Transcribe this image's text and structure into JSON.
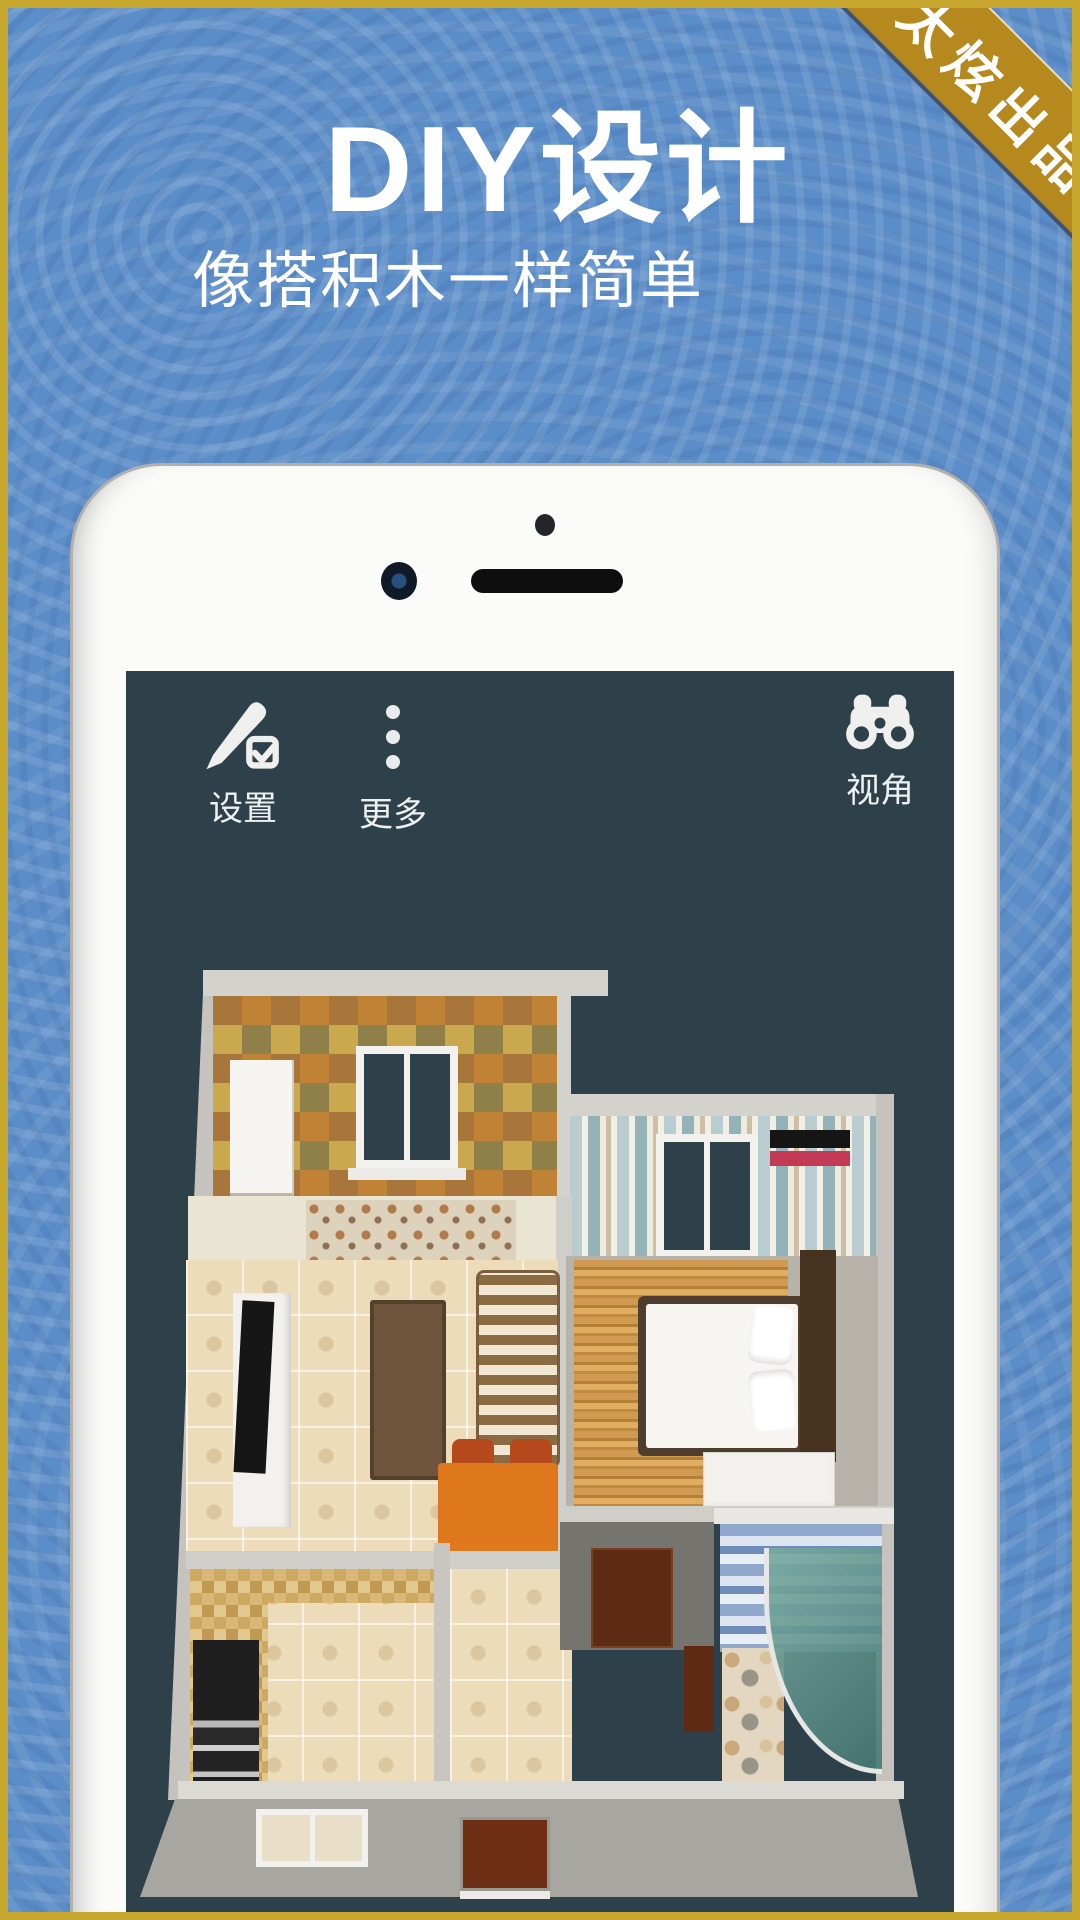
{
  "poster": {
    "ribbon_text": "太炫出品",
    "title": "DIY设计",
    "subtitle": "像搭积木一样简单"
  },
  "toolbar": {
    "settings": {
      "label": "设置",
      "icon": "pencil-edit-icon"
    },
    "more": {
      "label": "更多",
      "icon": "more-vertical-icon"
    },
    "view": {
      "label": "视角",
      "icon": "binoculars-icon"
    }
  },
  "colors": {
    "background_blue": "#5b8dc8",
    "frame_gold": "#c8a72e",
    "ribbon_gold": "#b5891d",
    "screen_slate": "#2e4049",
    "ac_red": "#c33a55",
    "dining_orange": "#e0791e"
  }
}
